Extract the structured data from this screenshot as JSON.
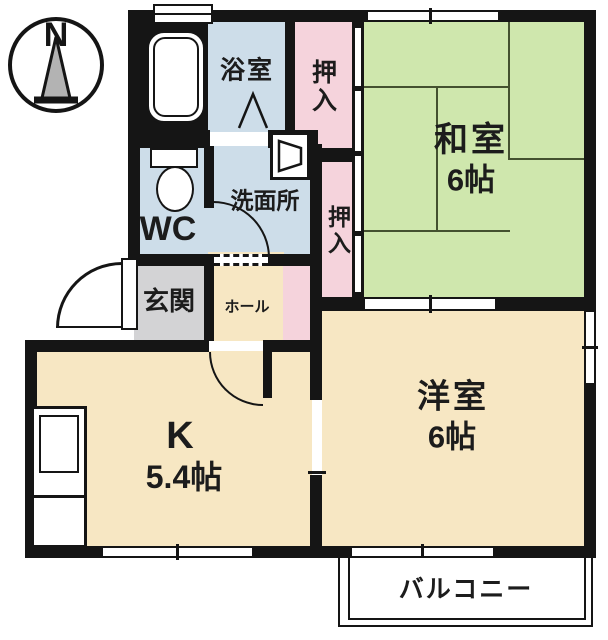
{
  "colors": {
    "wall": "#151515",
    "room-green": "#cfe7ad",
    "room-cream": "#f7e7c3",
    "room-pink": "#f5d3dc",
    "room-blue": "#cddde9",
    "room-gray": "#d3d3d5",
    "tatami-line": "#44512f",
    "text": "#1c1c1c"
  },
  "compass": {
    "north_label": "N"
  },
  "rooms": {
    "bathroom": {
      "label": "浴室"
    },
    "closet_top": {
      "label": "押入"
    },
    "japanese_room": {
      "label": "和室",
      "size": "6帖"
    },
    "washroom": {
      "label": "洗面所"
    },
    "closet_middle": {
      "label": "押入"
    },
    "toilet": {
      "label": "WC"
    },
    "entrance": {
      "label": "玄関"
    },
    "hall": {
      "label": "ホール"
    },
    "kitchen": {
      "label": "K",
      "size": "5.4帖"
    },
    "western_room": {
      "label": "洋室",
      "size": "6帖"
    },
    "balcony": {
      "label": "バルコニー"
    }
  }
}
